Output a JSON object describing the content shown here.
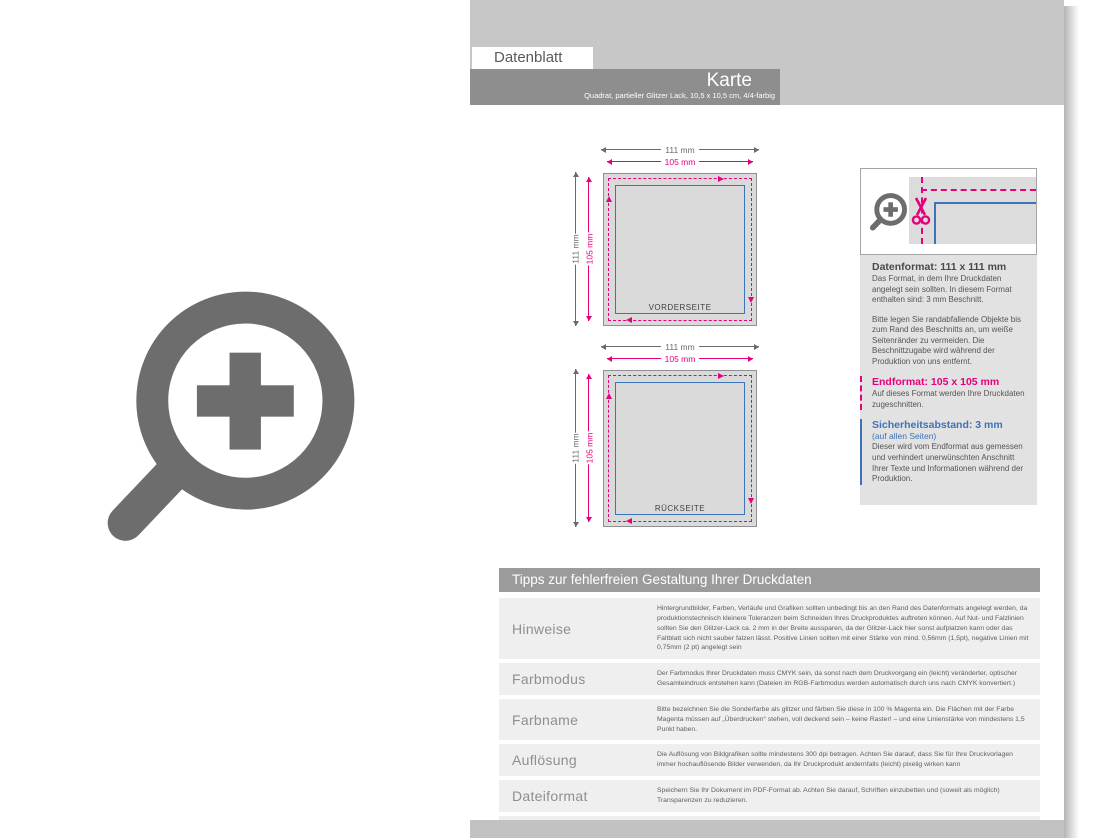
{
  "page": {
    "tab_label": "Datenblatt",
    "title": "Karte",
    "subtitle": "Quadrat, partieller Glitzer Lack,  10,5 x 10,5 cm, 4/4-farbig"
  },
  "diagrams": [
    {
      "label": "VORDERSEITE",
      "width_outer": "111 mm",
      "width_inner": "105 mm",
      "height_outer": "111 mm",
      "height_inner": "105 mm"
    },
    {
      "label": "RÜCKSEITE",
      "width_outer": "111 mm",
      "width_inner": "105 mm",
      "height_outer": "111 mm",
      "height_inner": "105 mm"
    }
  ],
  "info_panel": {
    "datenformat_title": "Datenformat: 111 x 111 mm",
    "datenformat_text": "Das Format, in dem Ihre Druckdaten angelegt sein sollten. In diesem Format enthalten sind: 3 mm Beschnitt.",
    "bleed_text": "Bitte legen Sie randabfallende Objekte bis zum Rand des Beschnitts an, um weiße Seitenränder zu vermeiden. Die Beschnittzugabe wird während der Produktion von uns entfernt.",
    "endformat_title": "Endformat: 105 x 105 mm",
    "endformat_text": "Auf dieses Format werden Ihre Druckdaten zugeschnitten.",
    "sicherheitsabstand_title": "Sicherheitsabstand: 3 mm",
    "sicherheitsabstand_sub": "(auf allen Seiten)",
    "sicherheitsabstand_text": "Dieser wird vom Endformat aus gemessen und verhindert unerwünschten Anschnitt Ihrer Texte und Informationen während der Produktion."
  },
  "tips_table": {
    "header": "Tipps zur fehlerfreien Gestaltung Ihrer Druckdaten",
    "rows": [
      {
        "label": "Hinweise",
        "text": "Hintergrundbilder, Farben, Verläufe und Grafiken sollten unbedingt bis an den Rand des Datenformats angelegt werden, da produktionstechnisch kleinere Toleranzen beim Schneiden Ihres Druckproduktes auftreten können. Auf Nut- und Falzlinien sollten Sie den Glitzer-Lack ca. 2 mm in der Breite aussparen, da der Glitzer-Lack hier sonst aufplatzen kann oder das Faltblatt sich nicht sauber falzen lässt. Positive Linien sollten mit einer Stärke von mind. 0,56mm (1,5pt), negative Linien mit 0,75mm (2 pt) angelegt sein"
      },
      {
        "label": "Farbmodus",
        "text": "Der Farbmodus Ihrer Druckdaten muss CMYK sein, da sonst nach dem Druckvorgang ein (leicht) veränderter, optischer Gesamteindruck entstehen kann (Dateien im RGB-Farbmodus werden automatisch durch uns nach CMYK konvertiert.)"
      },
      {
        "label": "Farbname",
        "text": "Bitte bezeichnen Sie die Sonderfarbe als glitzer und färben Sie diese in 100 % Magenta ein. Die Flächen mit der Farbe Magenta müssen auf „Überdrucken“ stehen, voll deckend sein – keine Raster! – und eine Linienstärke von mindestens 1,5 Punkt haben."
      },
      {
        "label": "Auflösung",
        "text": "Die Auflösung von Bildgrafiken sollte mindestens 300 dpi betragen. Achten Sie darauf, dass Sie für Ihre Druckvorlagen immer hochauflösende Bilder verwenden, da Ihr Druckprodukt andernfalls (leicht) pixelig wirken kann"
      },
      {
        "label": "Dateiformat",
        "text": "Speichern Sie Ihr Dokument im PDF-Format ab. Achten Sie darauf, Schriften einzubetten und (soweit als möglich) Transparenzen zu reduzieren."
      },
      {
        "label": "Seiten(-reihenfolge)",
        "text": "Senden Sie mehrseitige Dokumente chronologisch in korrekter Reihenfolge als eine einzige PDF-Datei oder benennen Sie Einzeldokumente entsprechend mit fortlaufenden Seitennummern."
      }
    ]
  },
  "icons": {
    "zoom_plus_icon": "magnifier with plus sign",
    "scissors_icon": "scissors cut mark"
  },
  "colors": {
    "magenta_bleed": "#e6007e",
    "blue_safety": "#3d73b8",
    "header_band": "#c7c7c7",
    "title_bar": "#8e8e8e",
    "table_header": "#9b9b9b",
    "row_bg": "#efefef",
    "icon_gray": "#6d6d6d"
  }
}
